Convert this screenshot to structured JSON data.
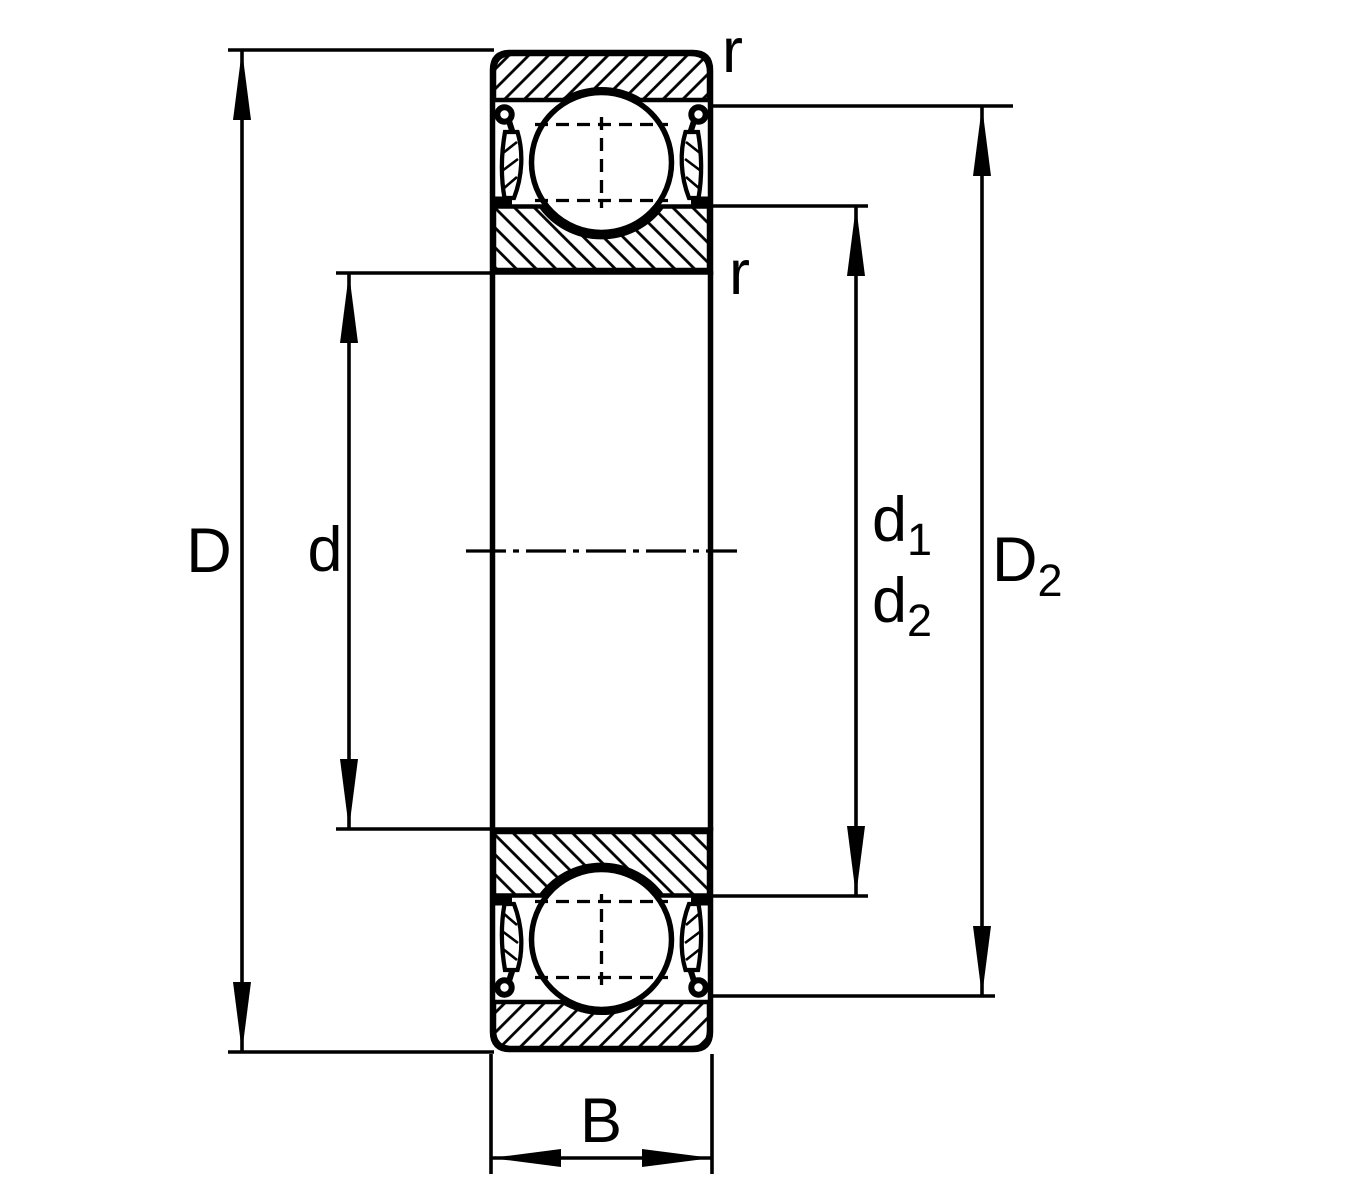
{
  "figure": {
    "type": "technical-drawing",
    "subject": "Deep groove ball bearing with shields (2Z) - axial cross-section with dimension lines"
  },
  "labels": {
    "D": "D",
    "d": "d",
    "d1": {
      "base": "d",
      "sub": "1"
    },
    "d2": {
      "base": "d",
      "sub": "2"
    },
    "D2": {
      "base": "D",
      "sub": "2"
    },
    "B": "B",
    "r_top": "r",
    "r_mid": "r"
  },
  "colors": {
    "line": "#000000",
    "background": "#ffffff"
  }
}
